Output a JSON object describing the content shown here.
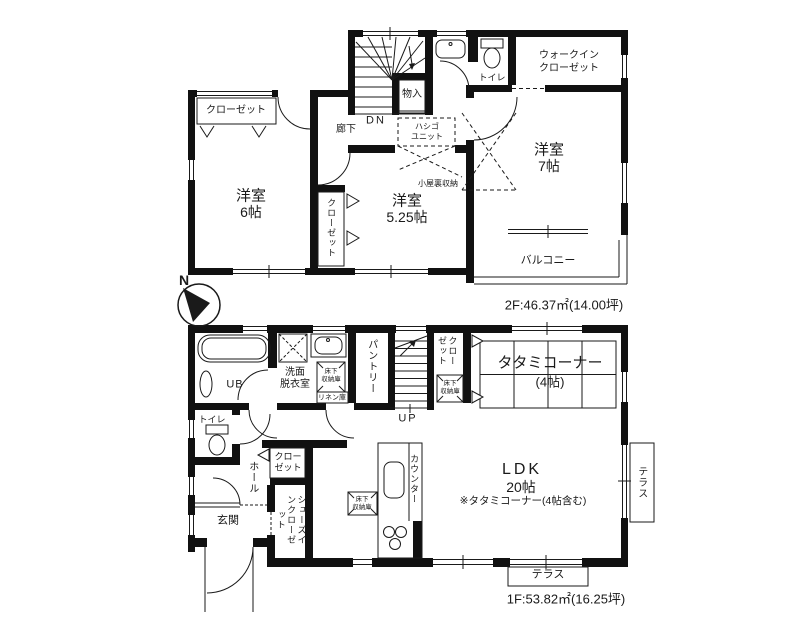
{
  "compass": {
    "north": "N"
  },
  "floor2": {
    "area_label": "2F:46.37㎡(14.00坪)",
    "rooms": {
      "closet_west": "クローゼット",
      "bedroom6": {
        "name": "洋室",
        "size": "6帖"
      },
      "hallway": "廊下",
      "stairs_down": "DN",
      "storage": "物入",
      "ladder_unit": {
        "line1": "ハシゴ",
        "line2": "ユニット"
      },
      "attic_storage": "小屋裏収納",
      "bedroom525": {
        "name": "洋室",
        "size": "5.25帖"
      },
      "closet_525": "クローゼット",
      "toilet": "トイレ",
      "wic": {
        "line1": "ウォークイン",
        "line2": "クローゼット"
      },
      "bedroom7": {
        "name": "洋室",
        "size": "7帖"
      },
      "balcony": "バルコニー"
    }
  },
  "floor1": {
    "area_label": "1F:53.82㎡(16.25坪)",
    "rooms": {
      "bath": "UB",
      "washroom": {
        "line1": "洗面",
        "line2": "脱衣室"
      },
      "underfloor_wash": {
        "line1": "床下",
        "line2": "収納庫"
      },
      "linen": "リネン庫",
      "pantry": "パントリー",
      "stairs_up": "UP",
      "closet_stairs": "クローゼット",
      "underfloor_stairs": {
        "line1": "床下",
        "line2": "収納庫"
      },
      "tatami_corner": {
        "name": "タタミコーナー",
        "size": "(4帖)"
      },
      "toilet": "トイレ",
      "hall": "ホール",
      "closet_hall": {
        "line1": "クロー",
        "line2": "ゼット"
      },
      "shoes_in_closet": "シューズインクローゼット",
      "entrance": "玄関",
      "underfloor_kitchen": {
        "line1": "床下",
        "line2": "収納庫"
      },
      "counter": "カウンター",
      "ldk": {
        "name": "LDK",
        "size": "20帖",
        "note": "※タタミコーナー(4帖含む)"
      },
      "terrace_side": "テラス",
      "terrace_south": "テラス"
    }
  }
}
